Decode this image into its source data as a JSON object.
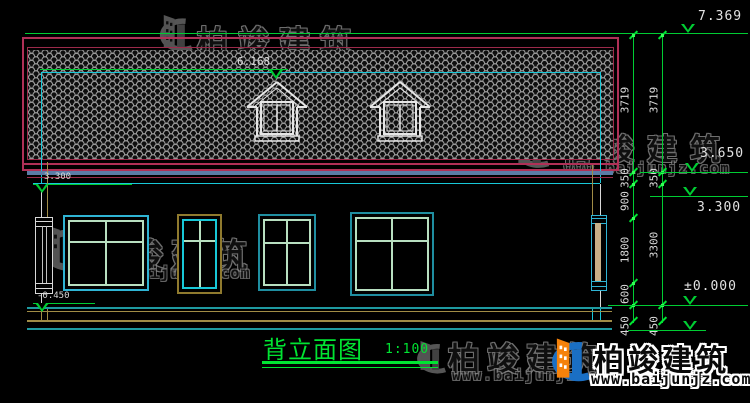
{
  "drawing": {
    "title": "背立面图",
    "scale": "1:100",
    "levels": {
      "roof_top": "7.369",
      "ridge": "6.168",
      "eave": "3.650",
      "story2": "3.300",
      "story2_left": "3.300",
      "zero": "±0.000",
      "base_left": "-0.450"
    },
    "dims_inner": [
      "3719",
      "350",
      "900",
      "1800",
      "600",
      "450"
    ],
    "dims_outer": [
      "3719",
      "350",
      "3300",
      "450"
    ]
  },
  "watermark": {
    "brand": "柏竣建筑",
    "url": "www.baijunjz.com"
  },
  "colors": {
    "background": "#000000",
    "roof_border": "#9c2a4a",
    "tile_line": "#969696",
    "cyan": "#18c8d8",
    "annotation_green": "#00cc33",
    "title_green": "#00e432",
    "dim_text": "#dcdcdc",
    "tan_trim": "#a08c46",
    "eave_steel": "#5b7ca6",
    "window_teal": "#1f8ea0",
    "window_pale": "#b8dfc0",
    "brand_blue": "#1a6fc4",
    "brand_orange": "#f5820b"
  }
}
